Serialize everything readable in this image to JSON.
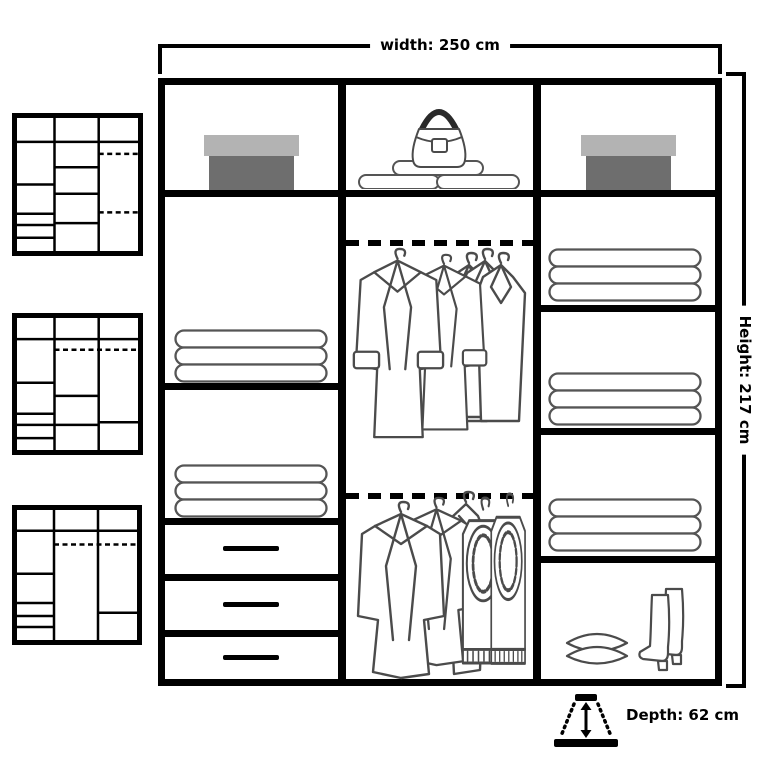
{
  "title": "Wardrobe dimensions diagram",
  "dimensions": {
    "width_label": "width: 250 cm",
    "height_label": "Height: 217 cm",
    "depth_label": "Depth: 62 cm"
  },
  "wardrobe": {
    "columns": [
      {
        "name": "left",
        "sections": [
          "top shelf with storage box",
          "shelf with folded towels",
          "shelf with folded towels",
          "drawer",
          "drawer",
          "drawer"
        ]
      },
      {
        "name": "middle",
        "sections": [
          "top shelf with handbag and rolled towels",
          "hanging rail with coats and shirts",
          "hanging rail with jackets and jeans"
        ]
      },
      {
        "name": "right",
        "sections": [
          "top shelf with storage box",
          "shelf with folded towels",
          "shelf with folded towels",
          "shelf with folded towels",
          "shelf with pillows and boots"
        ]
      }
    ]
  },
  "thumbnails": [
    {
      "name": "layout-variant-1",
      "description": "schematic: shelves and drawers left, five shelves centre, double hanging rail right"
    },
    {
      "name": "layout-variant-2",
      "description": "schematic: shelves and drawers left, hanging rail with shelves centre and right"
    },
    {
      "name": "layout-variant-3",
      "description": "schematic: shelves and drawers left, full-height hanging centre, hanging with shelf right"
    }
  ],
  "colors": {
    "line": "#000000",
    "clothes_outline": "#4b4b4b",
    "box_lid": "#b3b3b3",
    "box_body": "#6e6e6e",
    "background": "#ffffff"
  }
}
